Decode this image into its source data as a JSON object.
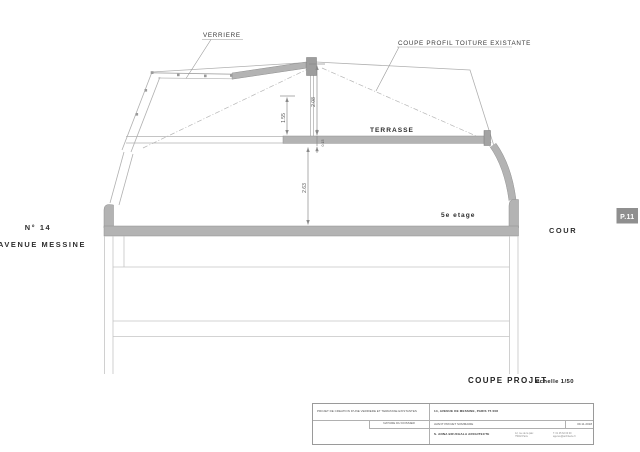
{
  "colors": {
    "cut_fill": "#b3b3b3",
    "thin_line": "#adadad",
    "dim_line": "#8a8a8a",
    "badge_bg": "#8f8f8f",
    "text": "#333333"
  },
  "drawing": {
    "callouts": {
      "verriere": "VERRIERE",
      "roof_profile": "COUPE PROFIL TOITURE EXISTANTE"
    },
    "labels": {
      "terrasse": "TERRASSE",
      "floor": "5e etage",
      "cour": "COUR",
      "street_number": "N° 14",
      "street_name": "AVENUE MESSINE"
    },
    "dimensions": {
      "ridge_height": "2.08",
      "under_roof": "1.55",
      "slab_thickness": "0.15",
      "ceiling_height": "2.63"
    },
    "page_badge": "P.11"
  },
  "caption": {
    "title": "COUPE PROJET",
    "scale": "échelle 1/50"
  },
  "title_block": {
    "project": "PROJET DE CREATION D'UNE VERRIERE ET TERRASSE EXISTANTES",
    "address": "14, AVENUE DE MESSINE, PARIS 75 008",
    "dossier_label": "NATURE DU DOSSIER",
    "dossier_value": "AVANT PROJET SOMMAIRE",
    "architect": "S. ANNA BOUCHALA ARCHITECTE",
    "contact_1": "12, rue de la paix\n75002 Paris",
    "contact_2": "T. 01 45 62 00 00\nagence@architecte.fr",
    "date": "09.11.2018"
  }
}
